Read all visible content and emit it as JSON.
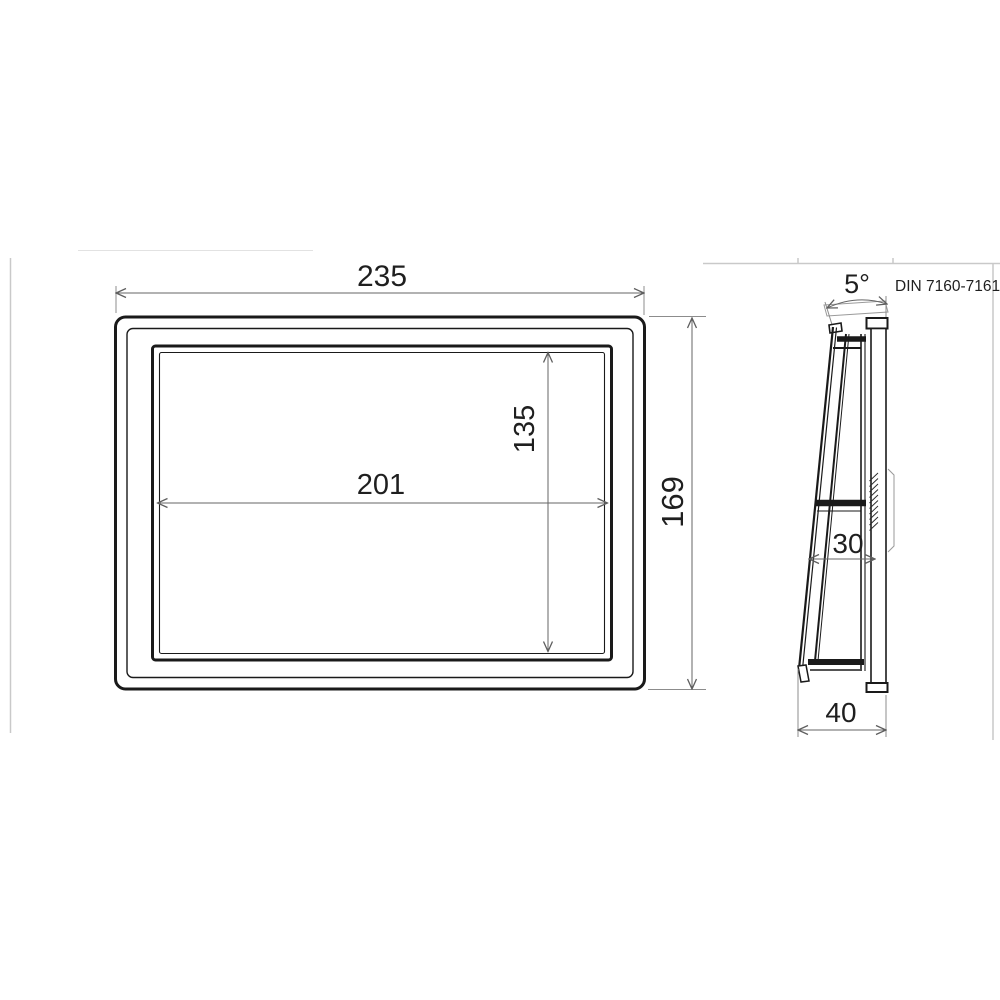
{
  "note": {
    "din_standard": "DIN 7160-7161"
  },
  "front_view": {
    "outer_width": "235",
    "outer_height": "169",
    "opening_width": "201",
    "opening_height": "135"
  },
  "side_view": {
    "tilt_angle": "5°",
    "inner_depth": "30",
    "overall_depth": "40"
  },
  "colors": {
    "object_line": "#1a1a1a",
    "dimension_line": "#666666",
    "faint_border": "#c9c9c9",
    "text": "#1f1f1f",
    "background": "#ffffff"
  }
}
